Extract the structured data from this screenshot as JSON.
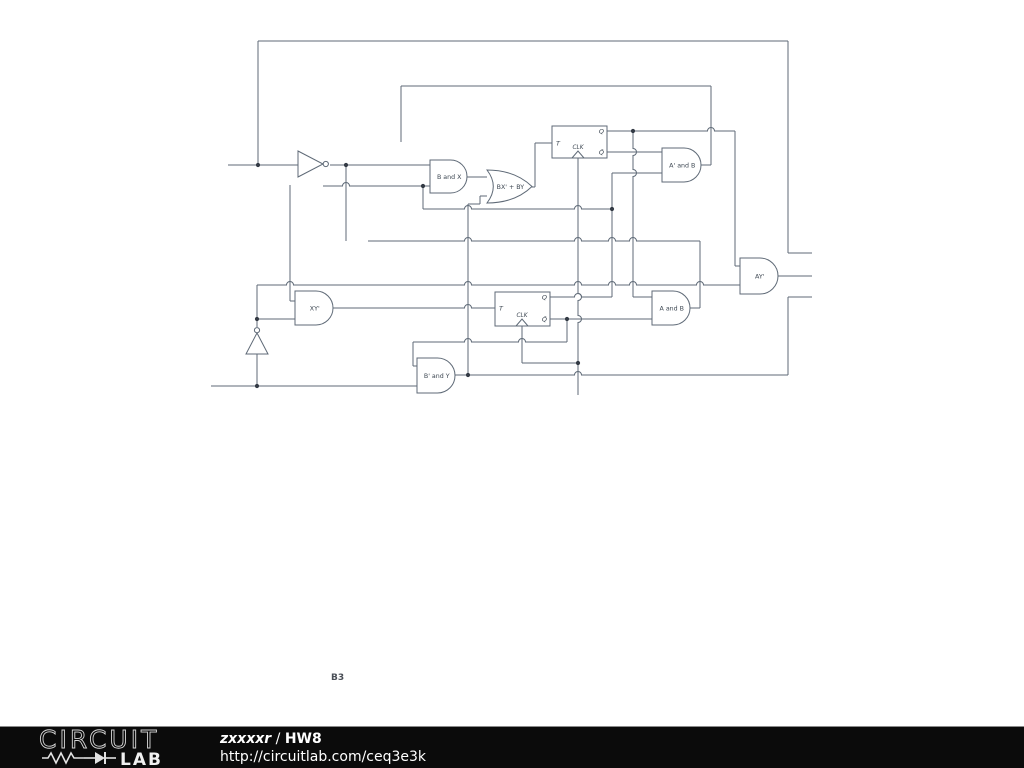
{
  "colors": {
    "wire": "#5f6a77",
    "text": "#3d4752",
    "dot": "#333a44",
    "bg": "#ffffff",
    "footer_bg": "#0b0b0b",
    "footer_text": "#ffffff",
    "logo_stroke": "#d6d6d6"
  },
  "annotation": {
    "label": "B3"
  },
  "footer": {
    "logo_word1": "CIRCUIT",
    "logo_word2": "LAB",
    "author": "zxxxxr",
    "separator": " / ",
    "title": "HW8",
    "url": "http://circuitlab.com/ceq3e3k"
  },
  "schematic": {
    "wires": [
      {
        "x1": 228,
        "y1": 165,
        "x2": 298,
        "y2": 165
      },
      {
        "x1": 258,
        "y1": 41,
        "x2": 788,
        "y2": 41
      },
      {
        "x1": 788,
        "y1": 253,
        "x2": 812,
        "y2": 253
      },
      {
        "x1": 778,
        "y1": 276,
        "x2": 812,
        "y2": 276
      },
      {
        "x1": 788,
        "y1": 297,
        "x2": 812,
        "y2": 297
      },
      {
        "x1": 401,
        "y1": 86,
        "x2": 711,
        "y2": 86
      },
      {
        "x1": 330,
        "y1": 165,
        "x2": 430,
        "y2": 165
      },
      {
        "x1": 323,
        "y1": 186,
        "x2": 430,
        "y2": 186,
        "hops": [
          346
        ]
      },
      {
        "x1": 607,
        "y1": 131,
        "x2": 735,
        "y2": 131,
        "hops": [
          711
        ]
      },
      {
        "x1": 607,
        "y1": 152,
        "x2": 662,
        "y2": 152
      },
      {
        "x1": 612,
        "y1": 173,
        "x2": 662,
        "y2": 173
      },
      {
        "x1": 423,
        "y1": 209,
        "x2": 612,
        "y2": 209,
        "hops": [
          468,
          578
        ]
      },
      {
        "x1": 368,
        "y1": 241,
        "x2": 700,
        "y2": 241,
        "hops": [
          468,
          578,
          612,
          633
        ]
      },
      {
        "x1": 257,
        "y1": 285,
        "x2": 740,
        "y2": 285,
        "hops": [
          290,
          468,
          578,
          612,
          633,
          700
        ]
      },
      {
        "x1": 550,
        "y1": 297,
        "x2": 612,
        "y2": 297,
        "hops": [
          578
        ]
      },
      {
        "x1": 633,
        "y1": 297,
        "x2": 652,
        "y2": 297
      },
      {
        "x1": 550,
        "y1": 319,
        "x2": 652,
        "y2": 319
      },
      {
        "x1": 257,
        "y1": 319,
        "x2": 295,
        "y2": 319
      },
      {
        "x1": 333,
        "y1": 308,
        "x2": 495,
        "y2": 308,
        "hops": [
          468
        ]
      },
      {
        "x1": 413,
        "y1": 342,
        "x2": 567,
        "y2": 342,
        "hops": [
          468,
          522
        ]
      },
      {
        "x1": 522,
        "y1": 363,
        "x2": 578,
        "y2": 363
      },
      {
        "x1": 211,
        "y1": 386,
        "x2": 417,
        "y2": 386
      },
      {
        "x1": 455,
        "y1": 375,
        "x2": 788,
        "y2": 375,
        "hops": [
          578
        ]
      },
      {
        "x1": 690,
        "y1": 308,
        "x2": 700,
        "y2": 308
      },
      {
        "x1": 701,
        "y1": 165,
        "x2": 711,
        "y2": 165
      },
      {
        "x1": 532,
        "y1": 187,
        "x2": 535,
        "y2": 187
      },
      {
        "x1": 467,
        "y1": 177,
        "x2": 487,
        "y2": 177
      },
      {
        "x1": 535,
        "y1": 143,
        "x2": 552,
        "y2": 143
      },
      {
        "x1": 290,
        "y1": 301,
        "x2": 295,
        "y2": 301
      },
      {
        "x1": 413,
        "y1": 366,
        "x2": 417,
        "y2": 366
      },
      {
        "x1": 480,
        "y1": 196,
        "x2": 487,
        "y2": 196
      },
      {
        "x1": 468,
        "y1": 204,
        "x2": 480,
        "y2": 204
      },
      {
        "x1": 735,
        "y1": 266,
        "x2": 740,
        "y2": 266
      },
      {
        "x1": 258,
        "y1": 41,
        "x2": 258,
        "y2": 165
      },
      {
        "x1": 788,
        "y1": 41,
        "x2": 788,
        "y2": 253
      },
      {
        "x1": 788,
        "y1": 297,
        "x2": 788,
        "y2": 375
      },
      {
        "x1": 711,
        "y1": 86,
        "x2": 711,
        "y2": 165
      },
      {
        "x1": 401,
        "y1": 86,
        "x2": 401,
        "y2": 142
      },
      {
        "x1": 535,
        "y1": 143,
        "x2": 535,
        "y2": 187
      },
      {
        "x1": 735,
        "y1": 131,
        "x2": 735,
        "y2": 266
      },
      {
        "x1": 633,
        "y1": 131,
        "x2": 633,
        "y2": 297,
        "hops": [
          152,
          173
        ]
      },
      {
        "x1": 612,
        "y1": 173,
        "x2": 612,
        "y2": 297
      },
      {
        "x1": 423,
        "y1": 186,
        "x2": 423,
        "y2": 209
      },
      {
        "x1": 346,
        "y1": 165,
        "x2": 346,
        "y2": 241
      },
      {
        "x1": 290,
        "y1": 185,
        "x2": 290,
        "y2": 301
      },
      {
        "x1": 257,
        "y1": 285,
        "x2": 257,
        "y2": 327
      },
      {
        "x1": 257,
        "y1": 354,
        "x2": 257,
        "y2": 386
      },
      {
        "x1": 468,
        "y1": 204,
        "x2": 468,
        "y2": 375
      },
      {
        "x1": 578,
        "y1": 158,
        "x2": 578,
        "y2": 395,
        "hops": [
          297,
          319
        ]
      },
      {
        "x1": 522,
        "y1": 326,
        "x2": 522,
        "y2": 363
      },
      {
        "x1": 567,
        "y1": 319,
        "x2": 567,
        "y2": 342
      },
      {
        "x1": 700,
        "y1": 241,
        "x2": 700,
        "y2": 308
      },
      {
        "x1": 413,
        "y1": 342,
        "x2": 413,
        "y2": 366
      },
      {
        "x1": 480,
        "y1": 196,
        "x2": 480,
        "y2": 204
      }
    ],
    "dots": [
      [
        258,
        165
      ],
      [
        346,
        165
      ],
      [
        423,
        186
      ],
      [
        633,
        131
      ],
      [
        612,
        209
      ],
      [
        567,
        319
      ],
      [
        578,
        363
      ],
      [
        468,
        375
      ],
      [
        257,
        386
      ],
      [
        257,
        319
      ]
    ],
    "gates": [
      {
        "type": "and",
        "label": "B and X",
        "x": 430,
        "y": 160,
        "w": 37,
        "h": 33
      },
      {
        "type": "or",
        "label": "BX' + BY",
        "x": 487,
        "y": 170,
        "w": 45,
        "h": 33
      },
      {
        "type": "and",
        "label": "A' and B",
        "x": 662,
        "y": 148,
        "w": 39,
        "h": 34
      },
      {
        "type": "and",
        "label": "AY'",
        "x": 740,
        "y": 258,
        "w": 38,
        "h": 36
      },
      {
        "type": "and",
        "label": "XY'",
        "x": 295,
        "y": 291,
        "w": 38,
        "h": 34
      },
      {
        "type": "and",
        "label": "A and B",
        "x": 652,
        "y": 291,
        "w": 38,
        "h": 34
      },
      {
        "type": "and",
        "label": "B' and Y",
        "x": 417,
        "y": 358,
        "w": 38,
        "h": 35
      }
    ],
    "inverters": [
      {
        "dir": "right",
        "x": 298,
        "y": 151,
        "size": 26
      },
      {
        "dir": "up",
        "x": 257,
        "y": 354,
        "size": 22
      }
    ],
    "flipflops": [
      {
        "x": 552,
        "y": 126,
        "w": 55,
        "h": 32,
        "clk_x": 578,
        "t": "T",
        "clk": "CLK",
        "q": "Q",
        "qbar": "Q̄",
        "t_y": 143,
        "q_y": 131,
        "qbar_y": 152
      },
      {
        "x": 495,
        "y": 292,
        "w": 55,
        "h": 34,
        "clk_x": 522,
        "t": "T",
        "clk": "CLK",
        "q": "Q",
        "qbar": "Q̄",
        "t_y": 308,
        "q_y": 297,
        "qbar_y": 319
      }
    ]
  }
}
